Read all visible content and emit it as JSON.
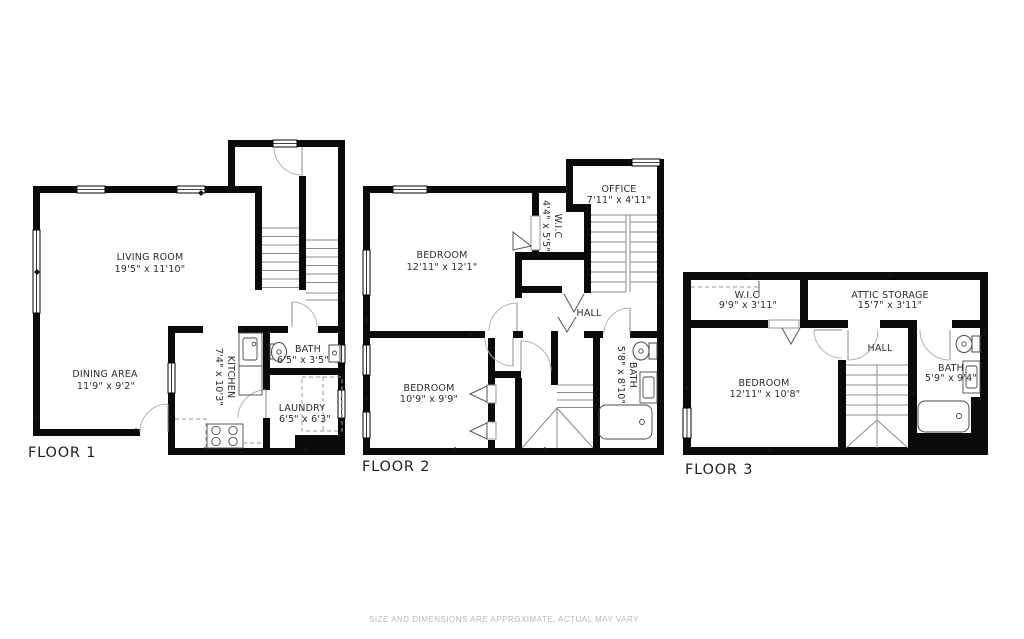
{
  "disclaimer": "SIZE AND DIMENSIONS ARE APPROXIMATE, ACTUAL MAY VARY",
  "floor1": {
    "label": "FLOOR 1",
    "living_room": {
      "name": "LIVING ROOM",
      "dims": "19'5\" x 11'10\""
    },
    "dining_area": {
      "name": "DINING AREA",
      "dims": "11'9\" x 9'2\""
    },
    "kitchen": {
      "name": "KITCHEN",
      "dims": "7'4\" x 10'3\""
    },
    "bath": {
      "name": "BATH",
      "dims": "6'5\" x 3'5\""
    },
    "laundry": {
      "name": "LAUNDRY",
      "dims": "6'5\" x 6'3\""
    }
  },
  "floor2": {
    "label": "FLOOR 2",
    "bedroom1": {
      "name": "BEDROOM",
      "dims": "12'11\" x 12'1\""
    },
    "bedroom2": {
      "name": "BEDROOM",
      "dims": "10'9\" x 9'9\""
    },
    "office": {
      "name": "OFFICE",
      "dims": "7'11\" x 4'11\""
    },
    "wic": {
      "name": "W.I.C",
      "dims": "4'4\" x 5'5\""
    },
    "hall": {
      "name": "HALL"
    },
    "bath": {
      "name": "BATH",
      "dims": "5'8\" x 8'10\""
    }
  },
  "floor3": {
    "label": "FLOOR 3",
    "wic": {
      "name": "W.I.C",
      "dims": "9'9\" x 3'11\""
    },
    "attic_storage": {
      "name": "ATTIC STORAGE",
      "dims": "15'7\" x 3'11\""
    },
    "bedroom": {
      "name": "BEDROOM",
      "dims": "12'11\" x 10'8\""
    },
    "hall": {
      "name": "HALL"
    },
    "bath": {
      "name": "BATH",
      "dims": "5'9\" x 9'4\""
    }
  }
}
